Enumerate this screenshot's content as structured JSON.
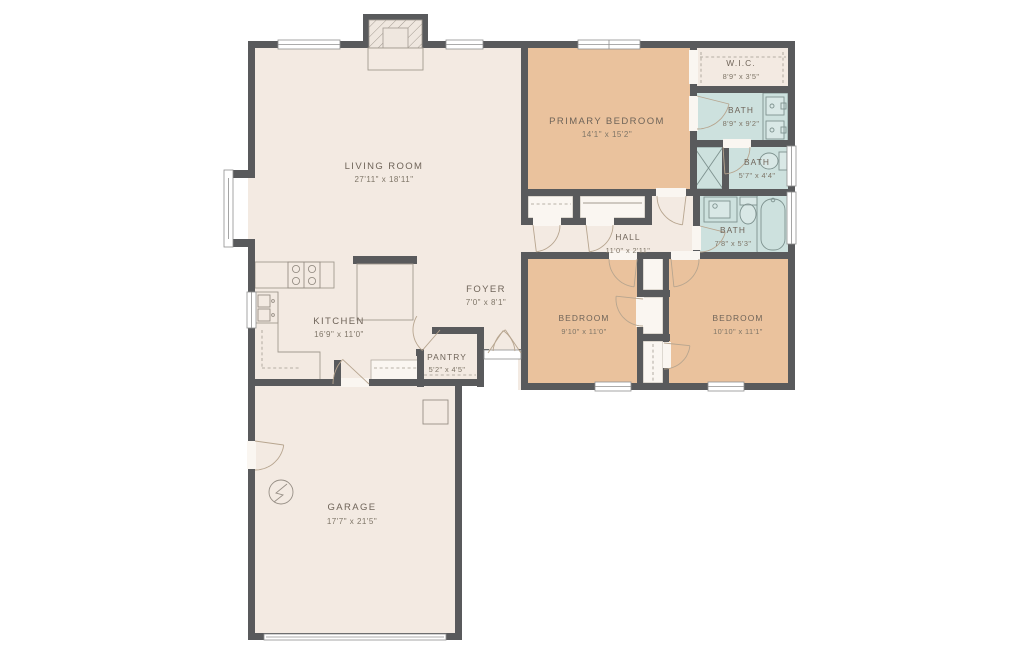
{
  "title": "Single-story house floor plan",
  "colors": {
    "wall": "#595a5c",
    "floor_cream": "#f3eae2",
    "bedroom_tan": "#eac29d",
    "bath_blue": "#cde1de",
    "label_text": "#6f6459",
    "dim_text": "#7e7567",
    "door_arc": "#b7a58f"
  },
  "rooms": {
    "living_room": {
      "name": "LIVING ROOM",
      "dims": "27'11\" x 18'11\""
    },
    "kitchen": {
      "name": "KITCHEN",
      "dims": "16'9\" x 11'0\""
    },
    "foyer": {
      "name": "FOYER",
      "dims": "7'0\" x 8'1\""
    },
    "pantry": {
      "name": "PANTRY",
      "dims": "5'2\" x 4'5\""
    },
    "garage": {
      "name": "GARAGE",
      "dims": "17'7\" x 21'5\""
    },
    "primary_bedroom": {
      "name": "PRIMARY BEDROOM",
      "dims": "14'1\" x 15'2\""
    },
    "wic": {
      "name": "W.I.C.",
      "dims": "8'9\" x 3'5\""
    },
    "bath_primary": {
      "name": "BATH",
      "dims": "8'9\" x 9'2\""
    },
    "bath_small": {
      "name": "BATH",
      "dims": "5'7\" x 4'4\""
    },
    "bath_hall": {
      "name": "BATH",
      "dims": "7'8\" x 5'3\""
    },
    "hall": {
      "name": "HALL",
      "dims": "11'0\" x 2'11\""
    },
    "bedroom_left": {
      "name": "BEDROOM",
      "dims": "9'10\" x 11'0\""
    },
    "bedroom_right": {
      "name": "BEDROOM",
      "dims": "10'10\" x 11'1\""
    }
  },
  "fixtures": [
    "fireplace",
    "kitchen-island",
    "range-stove",
    "kitchen-sink",
    "pantry-shelf",
    "double-vanity",
    "shower",
    "toilet",
    "bathtub",
    "vanity-sink",
    "washer-closet",
    "electrical-panel",
    "water-heater",
    "garage-door",
    "bay-window",
    "front-double-door"
  ]
}
